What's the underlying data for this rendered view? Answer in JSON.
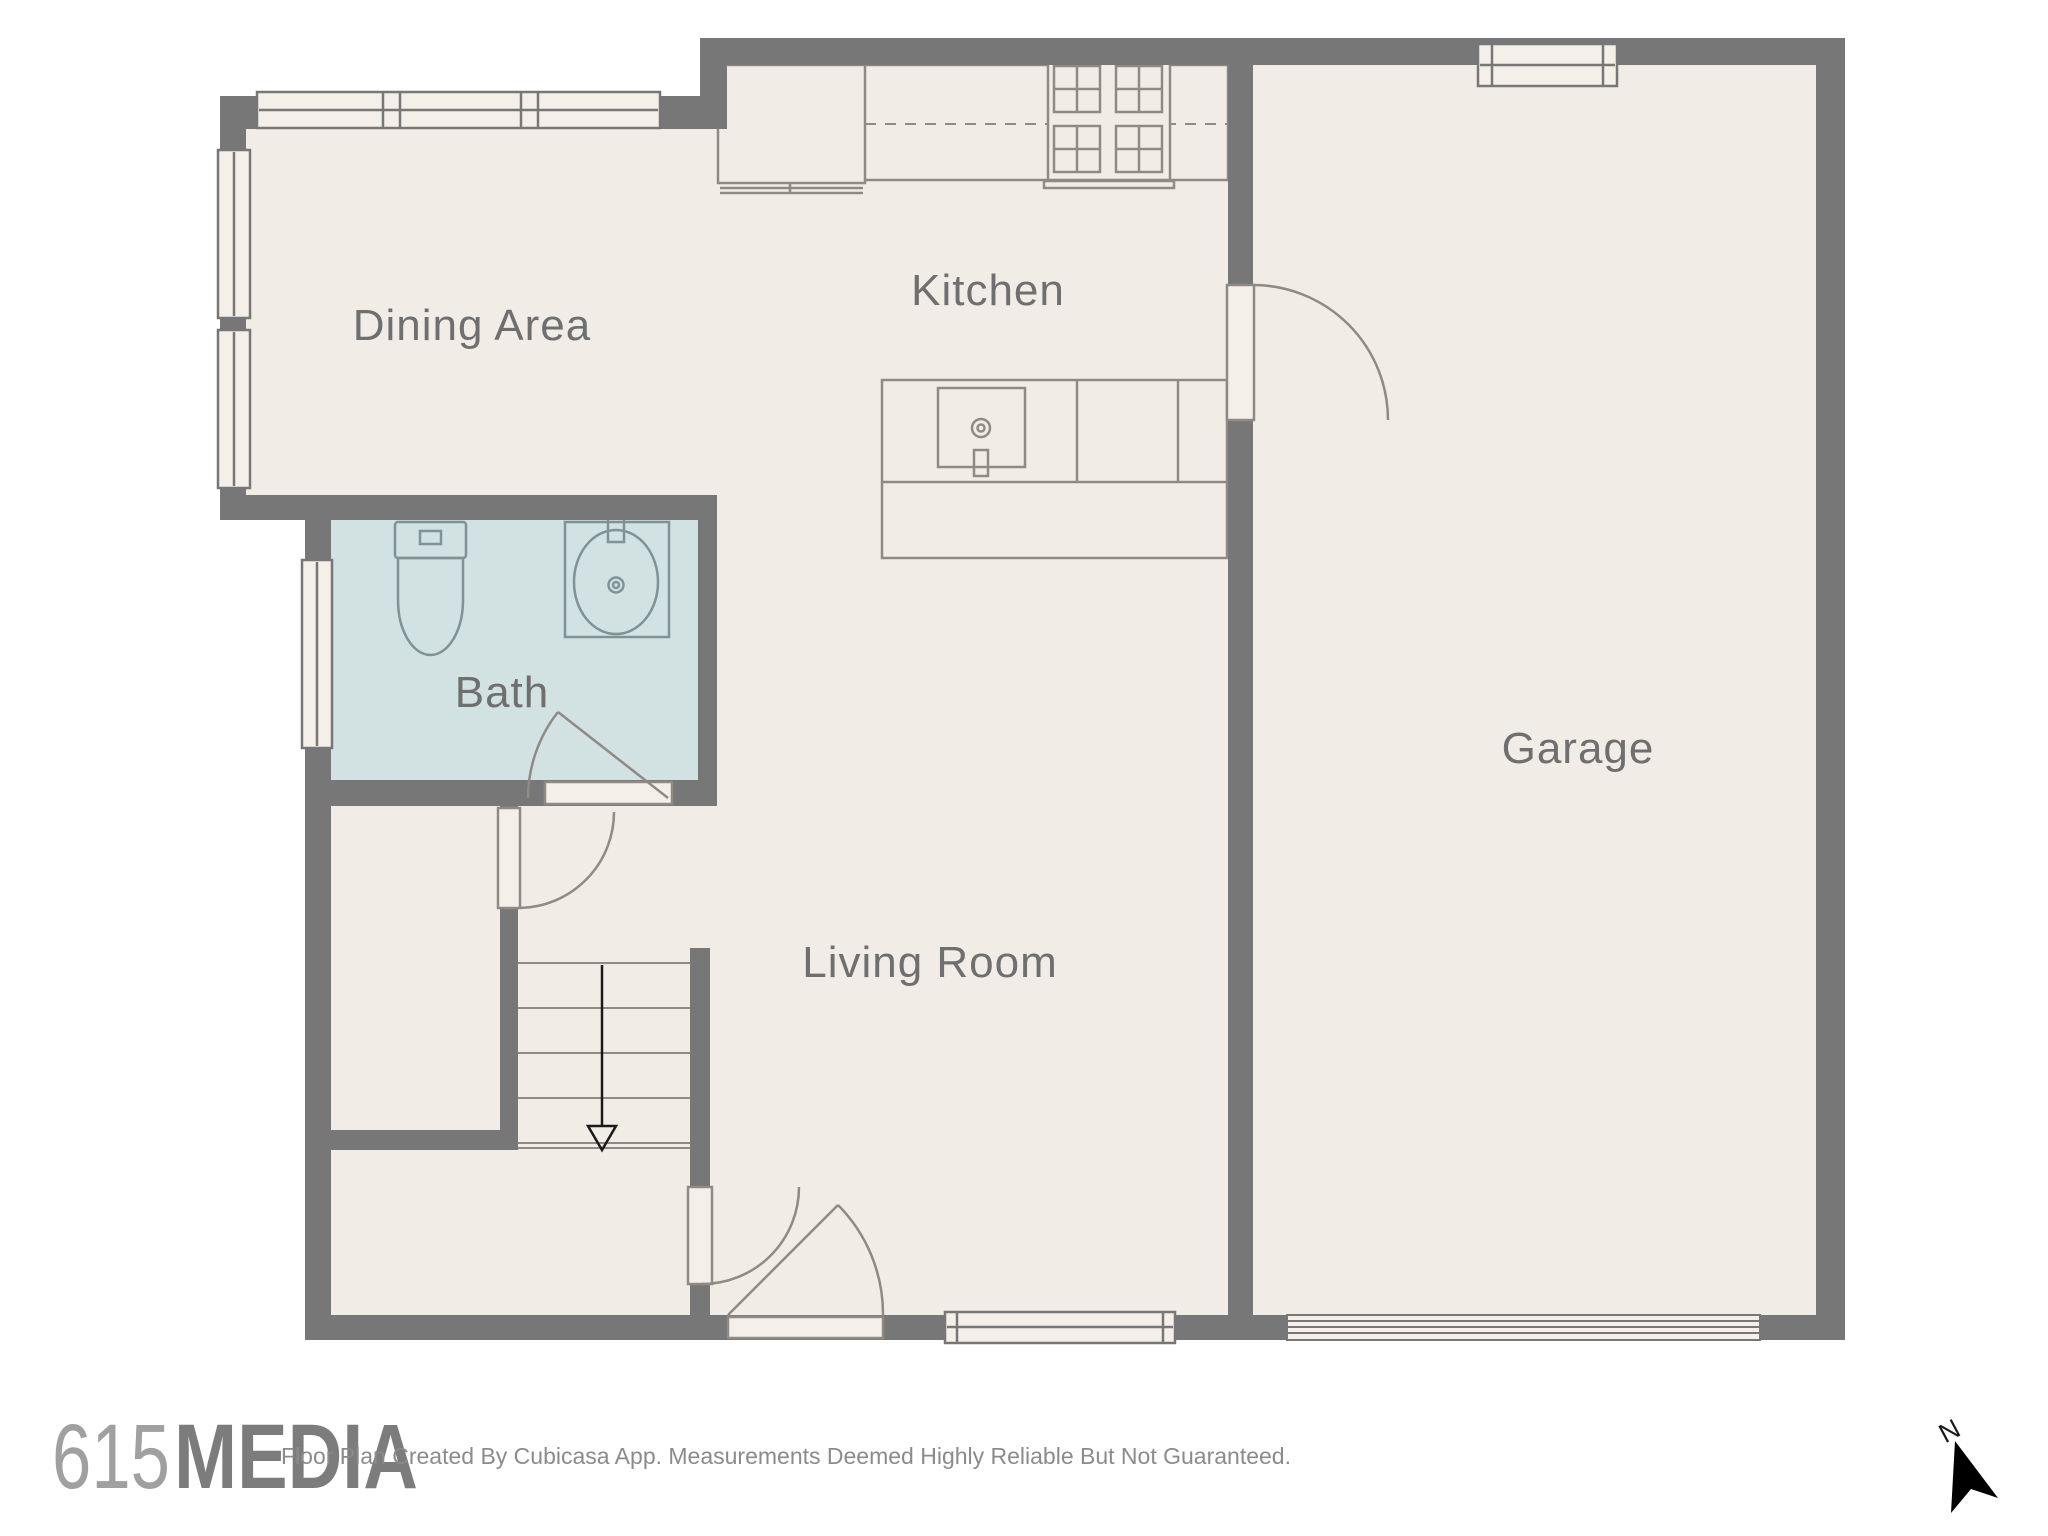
{
  "title": "Floor Plan",
  "rooms": {
    "dining": {
      "label": "Dining Area"
    },
    "kitchen": {
      "label": "Kitchen"
    },
    "bath": {
      "label": "Bath"
    },
    "living": {
      "label": "Living Room"
    },
    "garage": {
      "label": "Garage"
    }
  },
  "branding": {
    "logo_number": "615",
    "logo_word": "MEDIA"
  },
  "footer": {
    "disclaimer": "Floor Plan Created By Cubicasa App. Measurements Deemed Highly Reliable But Not Guaranteed."
  },
  "compass": {
    "north_label": "N"
  },
  "colors": {
    "wall": "#777777",
    "floor": "#f2ece6",
    "bath_floor": "#d2e1e2",
    "window_fill": "#f5efe9",
    "fixture_stroke": "#8f8a84",
    "bath_fixture_stroke": "#7f9294",
    "label_text": "#6f6f6f",
    "north_arrow": "#000000"
  }
}
